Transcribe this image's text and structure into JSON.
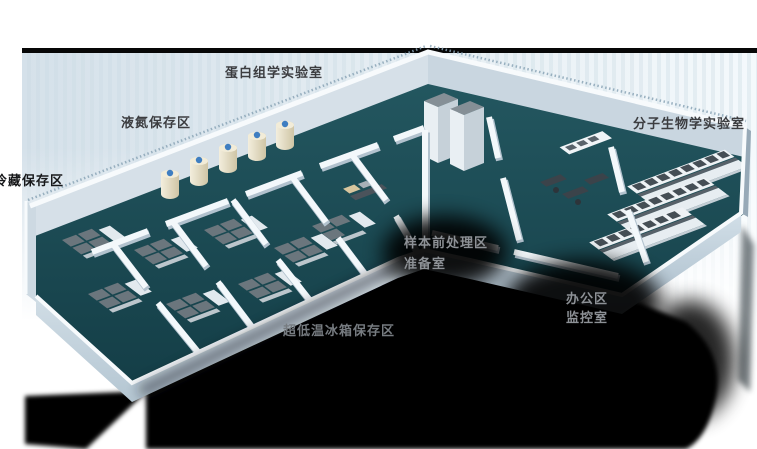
{
  "scene": {
    "description_labels": {
      "proteomics_lab": "蛋白组学实验室",
      "liquid_nitrogen_area": "液氮保存区",
      "cold_storage_area": "冷藏保存区",
      "molecular_biology_lab": "分子生物学实验室",
      "sample_pretreatment_area": "样本前处理区",
      "preparation_room": "准备室",
      "office_area": "办公区",
      "monitoring_room": "监控室",
      "ult_freezer_area": "超低温冰箱保存区"
    },
    "colors": {
      "top_bar_black": "#070707",
      "backdrop_blue": "#d8e3eb",
      "floor_teal": "#1c4e58",
      "wall_light": "#f3f8fb",
      "wall_shade": "#c3d1dc",
      "freezer_grey": "#6b767d",
      "tank_cream": "#e9e1c9",
      "tank_cap_blue": "#3f7ec1",
      "bench_top_grey": "#576169",
      "shadow_black": "#000000",
      "label_dark": "#3c3d40",
      "label_light": "#8d9196"
    }
  }
}
